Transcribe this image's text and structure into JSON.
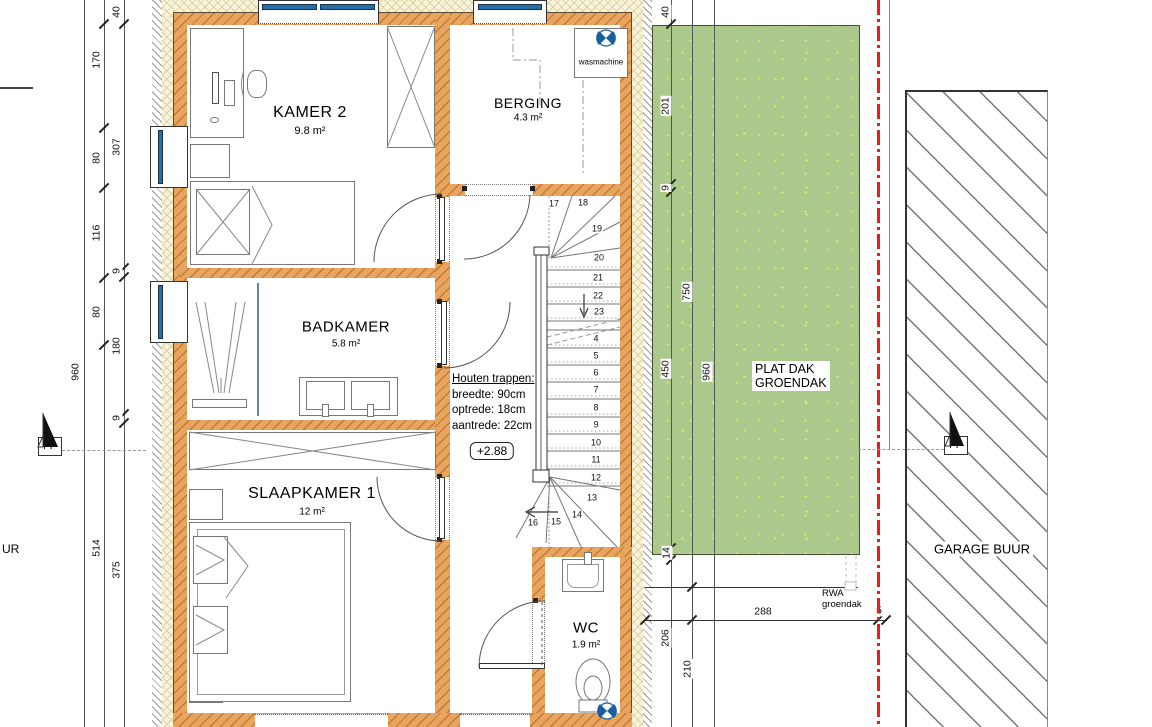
{
  "rooms": {
    "kamer2": {
      "name": "KAMER 2",
      "area": "9.8 m²"
    },
    "berging": {
      "name": "BERGING",
      "area": "4.3 m²"
    },
    "badkamer": {
      "name": "BADKAMER",
      "area": "5.8 m²"
    },
    "slaapkamer1": {
      "name": "SLAAPKAMER 1",
      "area": "12 m²"
    },
    "wc": {
      "name": "WC",
      "area": "1.9 m²"
    }
  },
  "annotations": {
    "wasmachine": "wasmachine",
    "plat_dak": {
      "line1": "PLAT DAK",
      "line2": "GROENDAK"
    },
    "rwa": {
      "line1": "RWA",
      "line2": "groendak"
    },
    "garage": "GARAGE BUUR",
    "neighbour_text": "UR",
    "fp": "FP",
    "level": "+2.88",
    "stair_note": {
      "title": "Houten trappen:",
      "l1": "breedte: 90cm",
      "l2": "optrede: 18cm",
      "l3": "aantrede: 22cm"
    }
  },
  "stairs": {
    "steps": [
      "17",
      "18",
      "19",
      "20",
      "21",
      "22",
      "23",
      "4",
      "5",
      "6",
      "7",
      "8",
      "9",
      "10",
      "11",
      "12",
      "13",
      "14",
      "15",
      "16"
    ]
  },
  "dimensions": {
    "left_outer": [
      "960"
    ],
    "left_mid": [
      "170",
      "80",
      "116",
      "80",
      "514"
    ],
    "left_inner": [
      "40",
      "307",
      "9",
      "180",
      "9",
      "375"
    ],
    "right_a": [
      "40",
      "201",
      "9",
      "450",
      "14",
      "206"
    ],
    "right_b": [
      "750",
      "210"
    ],
    "right_c": [
      "960"
    ],
    "bottom": [
      "288",
      "5"
    ]
  },
  "colors": {
    "wall": "#e9a55e",
    "wall_hatch": "#bf7b38",
    "insulation": "#f7f3dc",
    "green_roof": "#abc98c",
    "speckle": "#dcea67",
    "boundary_red": "#ec1c18",
    "window_blue": "#2a6ea8",
    "symbol_blue": "#1a5f9e"
  }
}
